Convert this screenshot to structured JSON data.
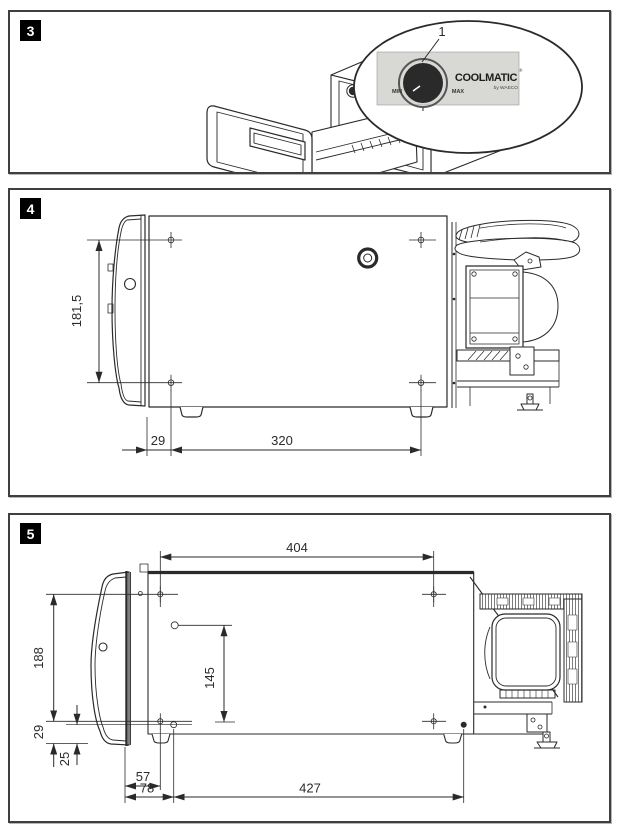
{
  "page": {
    "background": "#ffffff"
  },
  "colors": {
    "line": "#2a2a2a",
    "dim": "#2b2b2b",
    "border": "#3f3f3f",
    "knob_panel": "#d8d8d5",
    "badge_bg": "#000000",
    "badge_fg": "#ffffff"
  },
  "figure3": {
    "badge": "3",
    "callout_number": "1",
    "knob_min": "MIN",
    "knob_max": "MAX",
    "knob_zero": "0",
    "brand": "COOLMATIC",
    "brand_reg": "®",
    "brand_sub": "by WAECO"
  },
  "figure4": {
    "badge": "4",
    "dims": {
      "hole_height": "181,5",
      "front_offset": "29",
      "hole_spacing": "320"
    }
  },
  "figure5": {
    "badge": "5",
    "dims": {
      "top_spacing": "404",
      "side_depth": "188",
      "inner_hole": "145",
      "edge_offset": "29",
      "edge_offset2": "25",
      "front_57": "57",
      "front_78": "78",
      "bottom_span": "427"
    }
  }
}
